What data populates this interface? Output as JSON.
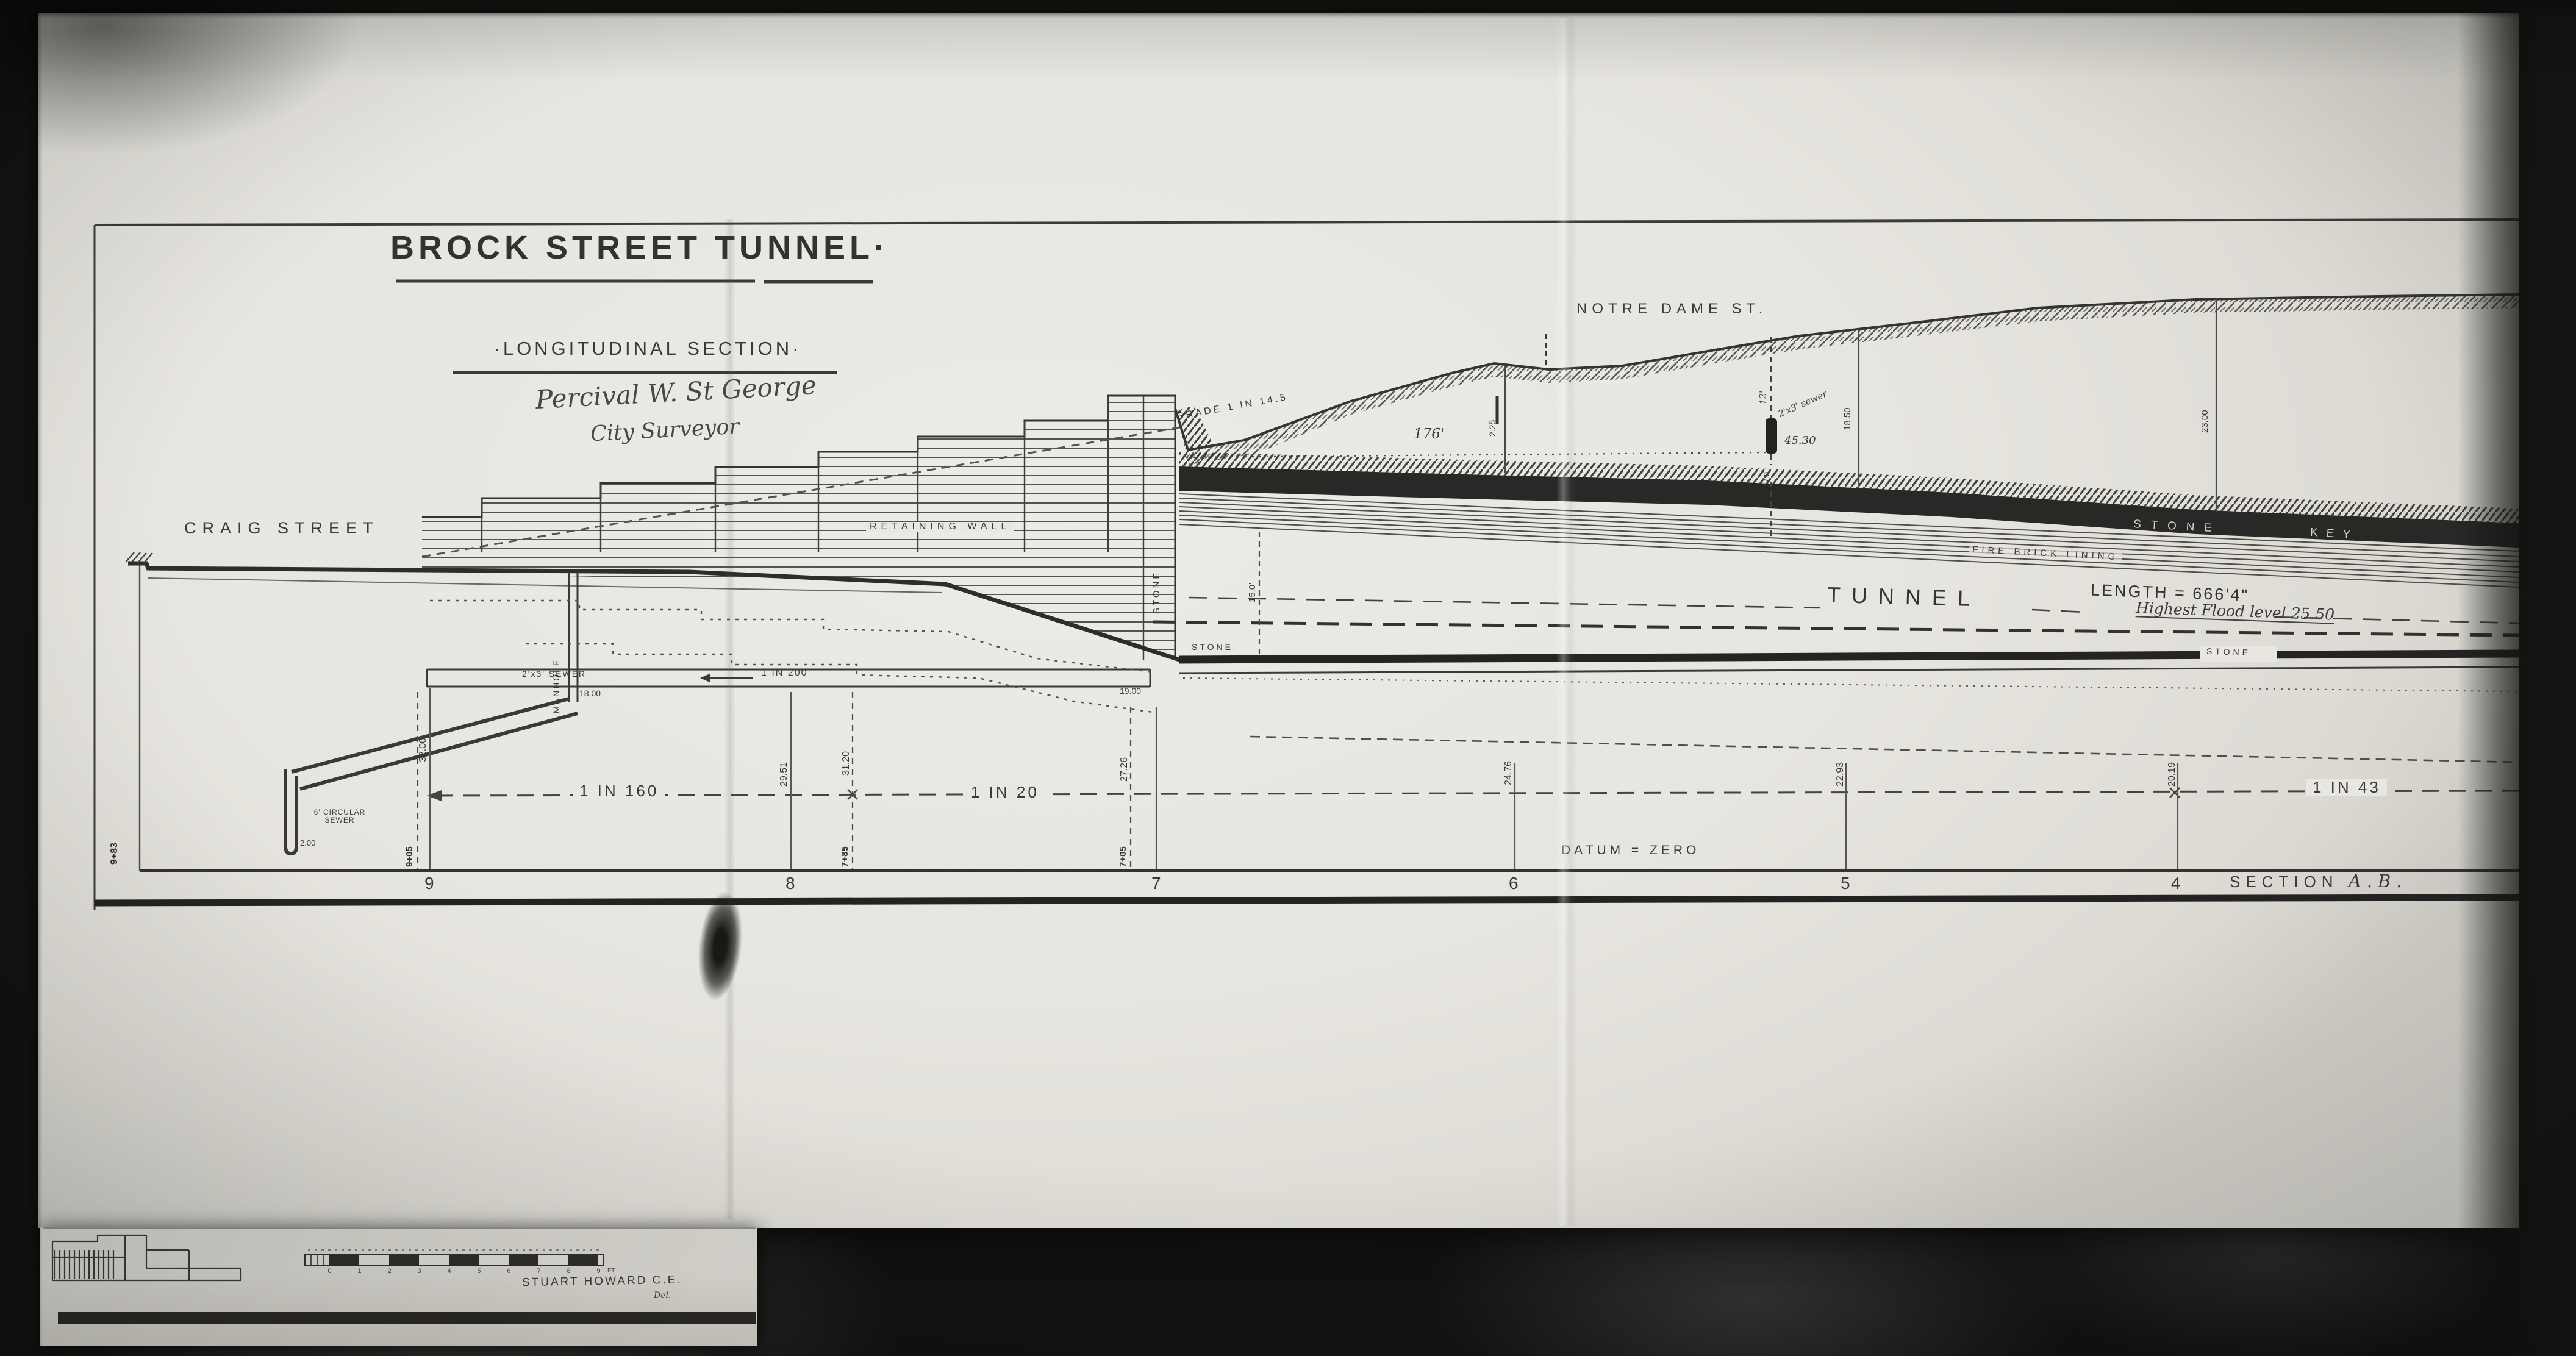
{
  "title": {
    "main": "BROCK STREET TUNNEL·",
    "sub": "·LONGITUDINAL SECTION·"
  },
  "approval": {
    "line1": "Percival W. St George",
    "line2": "City Surveyor"
  },
  "streets": {
    "craig": "CRAIG STREET",
    "notre_dame": "NOTRE DAME ST."
  },
  "structures": {
    "retaining_wall": "RETAINING WALL",
    "manhole": "MANHOLE",
    "box_sewer": "2'x3' SEWER",
    "box_sewer_grade": "1 IN 200",
    "box_sewer_invert_left": "18.00",
    "box_sewer_invert_right": "19.00",
    "circular_sewer": "6' CIRCULAR\nSEWER",
    "circular_sewer_invert": "2.00",
    "portal_stone": "STONE",
    "approach_grade": "GRADE   1 IN 14.5",
    "approach_length": "176'",
    "tunnel_height": "15.0'",
    "stone_key_left": "STONE",
    "stone_key_right": "KEY",
    "fire_brick": "FIRE BRICK LINING",
    "tunnel_word": "TUNNEL",
    "tunnel_length": "LENGTH = 666'4\"",
    "flood_level": "Highest Flood level    25.50",
    "floor_stone_left": "STONE",
    "floor_stone_right": "STONE"
  },
  "crossing": {
    "depth": "12'",
    "label": "2'x3' sewer",
    "elev": "45.30",
    "below": "7.0"
  },
  "depths": {
    "d1": "2.25",
    "d2": "18.50",
    "d3": "23.00"
  },
  "grades": {
    "left": "1 IN 160",
    "mid": "1 IN 20",
    "right": "1 IN 43"
  },
  "datum": "DATUM  =  ZERO",
  "section": {
    "label": "SECTION",
    "name": "A.B."
  },
  "chain_start": "9+83",
  "stations": [
    {
      "num": "9",
      "elev": "32.00",
      "chain": "9+05"
    },
    {
      "num": "8",
      "elev": "29.51",
      "aux_elev": "31.20",
      "aux_chain": "7+85"
    },
    {
      "num": "7",
      "elev": "27.26",
      "chain": "7+05"
    },
    {
      "num": "6",
      "elev": "24.76"
    },
    {
      "num": "5",
      "elev": "22.93"
    },
    {
      "num": "4",
      "elev": "20.19"
    }
  ],
  "scale_bar": {
    "ticks": [
      "0",
      "1",
      "2",
      "3",
      "4",
      "5",
      "6",
      "7",
      "8",
      "9"
    ],
    "unit": "FT"
  },
  "credit": {
    "name": "STUART HOWARD C.E.",
    "del": "Del."
  },
  "colors": {
    "paper": "#e9e7e1",
    "ink": "#3a3a3a",
    "band": "#272624"
  }
}
